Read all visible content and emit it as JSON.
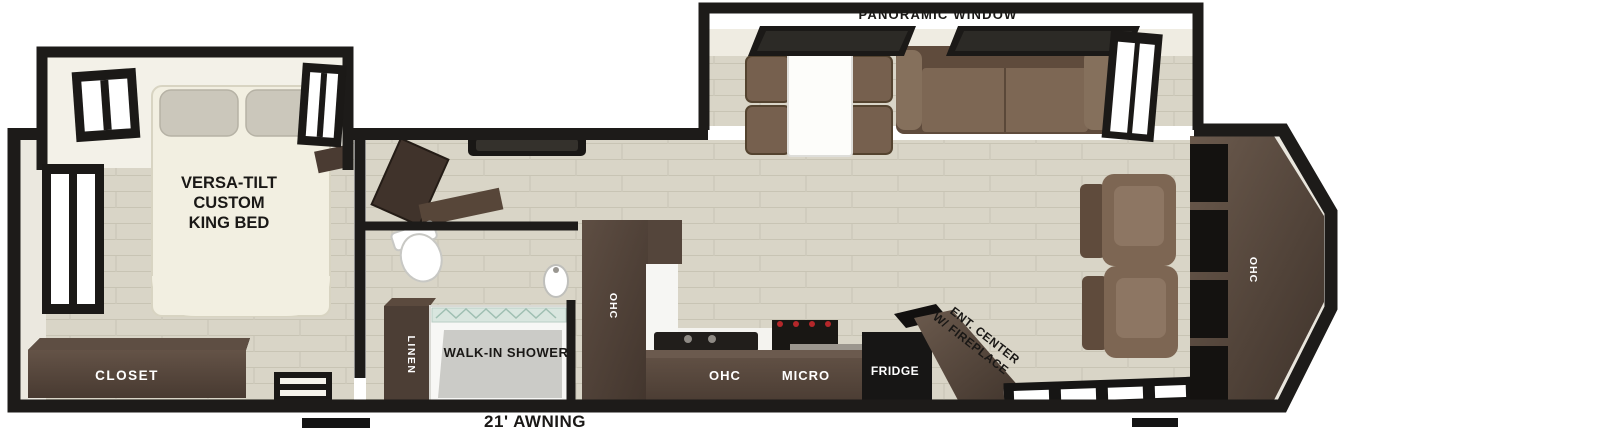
{
  "figure": {
    "type": "rv-floorplan"
  },
  "labels": {
    "panoramic_window": "PANORAMIC WINDOW",
    "bed_line1": "VERSA-TILT",
    "bed_line2": "CUSTOM",
    "bed_line3": "KING BED",
    "closet": "CLOSET",
    "linen": "LINEN",
    "walk_in_shower": "WALK-IN SHOWER",
    "pantry_ohc": "OHC",
    "counter_ohc": "OHC",
    "micro": "MICRO",
    "fridge": "FRIDGE",
    "ent_center_line1": "ENT. CENTER",
    "ent_center_line2": "W/ FIREPLACE",
    "rear_ohc": "OHC",
    "awning": "21' AWNING"
  },
  "colors": {
    "wall": "#1d1b19",
    "floor": "#d9d5c7",
    "dark_wood": "#4e4036",
    "mid_wood": "#5d4c41",
    "upholstery": "#7b6351",
    "bed": "#f2efe1",
    "shower_glass": "#d9e6df",
    "label_dark": "#1a1816",
    "label_light": "#ffffff"
  }
}
